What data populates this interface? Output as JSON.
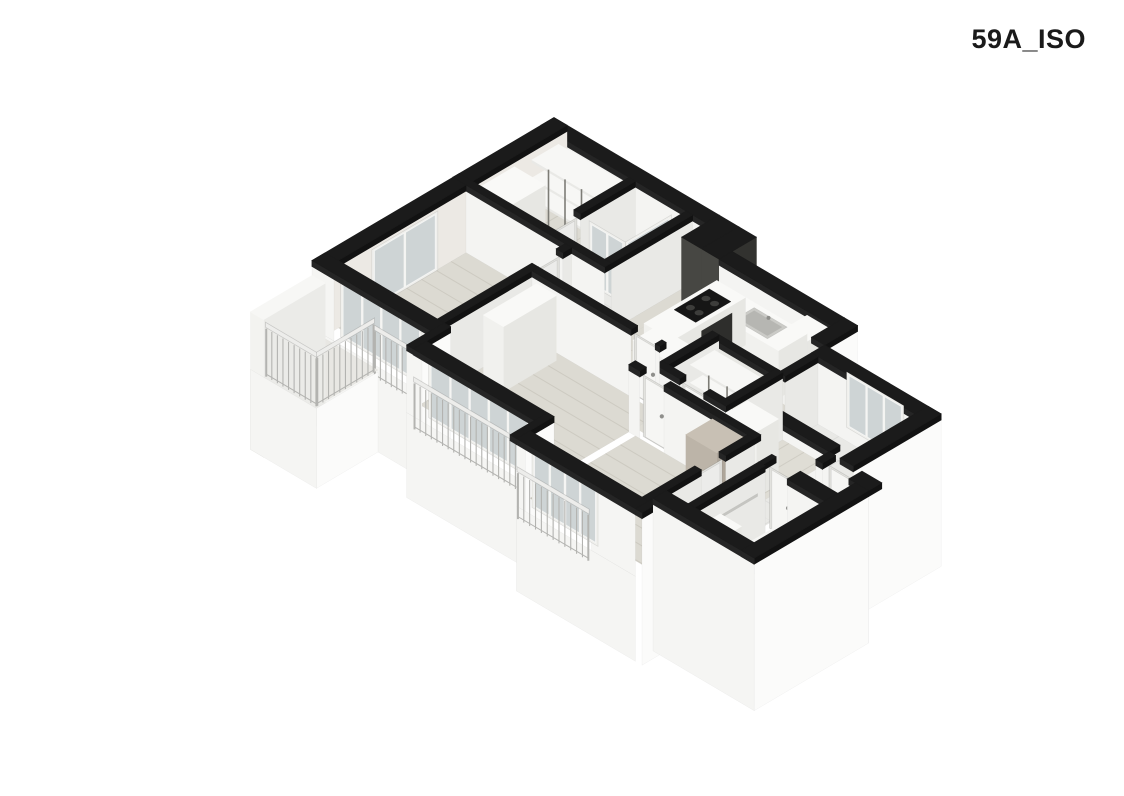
{
  "title": "59A_ISO",
  "canvas": {
    "width": 1124,
    "height": 796,
    "background": "#ffffff"
  },
  "projection": {
    "cx": 554,
    "cy": 185,
    "ax": 44,
    "ay": 26,
    "vz": 50
  },
  "palette": {
    "ink": "#1a1a1a",
    "capTop": "#1b1b1b",
    "capSW": "#252525",
    "capSE": "#121212",
    "intSW": "#f4f4f2",
    "intSE": "#e9e9e6",
    "intNW": "#ece9e4",
    "intDim": "#e7e7e3",
    "skirtSW": "#f5f5f3",
    "skirtSE": "#fbfbfa",
    "wood": "#dcdad2",
    "wood2": "#dfddd5",
    "woodLine": "rgba(95,88,72,0.12)",
    "tile": "#e9e9e6",
    "tileLine": "rgba(0,0,0,0.05)",
    "balc": "#e8e7e3",
    "boxTop": "#f9f9f7",
    "boxSW": "#f1f1ee",
    "boxSE": "#e7e7e3",
    "frame": "#f0f0ed",
    "glass": "rgba(186,196,199,0.62)",
    "mull": "#f5f5f3",
    "railB": "#b3b3b0",
    "railTop": "#ededeb",
    "shelfTop": "#f7f7f5",
    "shelfFront": "#e9e9e6",
    "shelfEdge": "#e2e2de",
    "post": "#7d7c76",
    "doorFrame": "#e2e2de",
    "doorSW": "#f6f6f4",
    "doorSE": "#ececea",
    "handle": "#8f8f8c",
    "shaftSW": "#474743",
    "shaftSE": "#32322f",
    "dark": "#2e2e2c"
  },
  "scene": [
    {
      "t": "floor",
      "name": "closet-hall-floor",
      "u0": 0.3,
      "v0": 0.3,
      "u1": 2.0,
      "v1": 2.15,
      "fill": "$wood",
      "planks": "B"
    },
    {
      "t": "floor",
      "name": "shower-room-floor",
      "u0": 2.15,
      "v0": 0.3,
      "u1": 3.3,
      "v1": 2.15,
      "fill": "$tile",
      "tiles": 0.47
    },
    {
      "t": "floor",
      "name": "vestibule-floor",
      "u0": 3.45,
      "v0": 0.3,
      "u1": 3.75,
      "v1": 2.3,
      "fill": "$wood",
      "planks": "B"
    },
    {
      "t": "wall",
      "name": "exterior-wall-north",
      "u0": 0,
      "v0": 0,
      "u1": 3.75,
      "v1": 0.3,
      "sw": "$intSW"
    },
    {
      "t": "wall",
      "name": "exterior-wall-northwest-upper",
      "u0": 0,
      "v0": 0,
      "u1": 0.3,
      "v1": 2.3,
      "se": "$intNW"
    },
    {
      "t": "shelf",
      "name": "closet-shelving",
      "u0": 0.45,
      "v0": 0.35,
      "u1": 1.95,
      "v1": 0.95,
      "levels": [
        0.42,
        0.82,
        1.18
      ],
      "posts": 3
    },
    {
      "t": "box",
      "name": "hall-wardrobe",
      "u0": 0.45,
      "v0": 1.35,
      "u1": 1.15,
      "v1": 2.1,
      "z0": 0,
      "z1": 1.3
    },
    {
      "t": "wall",
      "name": "closet-shower-partition",
      "u0": 2.0,
      "v0": 0.3,
      "u1": 2.15,
      "v1": 1.55,
      "se": "$intSE"
    },
    {
      "t": "door",
      "name": "shower-room-door",
      "dir": "B",
      "line": 2.07,
      "s0": 1.55,
      "s1": 2.1,
      "face": "se"
    },
    {
      "t": "glass",
      "name": "shower-glass-side",
      "dir": "B",
      "line": 3.12,
      "s0": 0.45,
      "s1": 1.5,
      "z0": 0,
      "z1": 1.26,
      "mullions": 0
    },
    {
      "t": "glass",
      "name": "shower-glass-front",
      "dir": "A",
      "line": 1.5,
      "s0": 2.3,
      "s1": 3.12,
      "z0": 0,
      "z1": 1.26,
      "mullions": 1
    },
    {
      "t": "wall",
      "name": "shower-east-wall",
      "u0": 3.3,
      "v0": 0.3,
      "u1": 3.45,
      "v1": 2.15,
      "se": "$intSE"
    },
    {
      "t": "wall",
      "name": "hall-south-wall",
      "u0": 0,
      "v0": 2.15,
      "u1": 3.45,
      "v1": 2.3,
      "sw": "$intSW"
    },
    {
      "t": "shaft",
      "name": "duct-shaft-1",
      "u0": 3.75,
      "v0": 0,
      "u1": 4.2,
      "v1": 0.85
    },
    {
      "t": "shaft",
      "name": "duct-shaft-2",
      "u0": 4.2,
      "v0": 0,
      "u1": 4.6,
      "v1": 0.85
    },
    {
      "t": "floor",
      "name": "kitchen-floor",
      "u0": 3.75,
      "v0": 0.85,
      "u1": 7.15,
      "v1": 2.3,
      "fill": "$wood",
      "planks": "B"
    },
    {
      "t": "wall",
      "name": "kitchen-north-wall",
      "u0": 4.6,
      "v0": 0.55,
      "u1": 7.15,
      "v1": 0.85,
      "sw": "$intSW"
    },
    {
      "t": "box",
      "name": "kitchen-tall-cabinet",
      "u0": 6.65,
      "v0": 0.9,
      "u1": 7.15,
      "v1": 1.6,
      "z0": 0,
      "z1": 1.32
    },
    {
      "t": "box",
      "name": "kitchen-counter",
      "u0": 5.25,
      "v0": 0.9,
      "u1": 6.65,
      "v1": 1.55,
      "z0": 0,
      "z1": 0.95
    },
    {
      "t": "sink",
      "name": "kitchen-sink",
      "u0": 5.55,
      "v0": 1.0,
      "u1": 6.3,
      "v1": 1.45,
      "z": 0.95
    },
    {
      "t": "box",
      "name": "kitchen-counter-return",
      "u0": 4.6,
      "v0": 0.9,
      "u1": 5.25,
      "v1": 2.55,
      "z0": 0,
      "z1": 0.95
    },
    {
      "t": "cooktop",
      "name": "cooktop",
      "u0": 4.68,
      "v0": 1.15,
      "u1": 5.17,
      "v1": 1.95,
      "z": 0.95
    },
    {
      "t": "face",
      "name": "oven-front",
      "dir": "B",
      "line": 5.25,
      "s0": 1.2,
      "s1": 1.9,
      "z0": 0.18,
      "z1": 0.8,
      "fill": "$dark"
    },
    {
      "t": "wall",
      "name": "kitchen-laundry-step-wall",
      "u0": 7.15,
      "v0": 0.55,
      "u1": 7.45,
      "v1": 1.3,
      "se": "$skirtSE",
      "z0": -1.7
    },
    {
      "t": "wall",
      "name": "laundry-north-wall",
      "u0": 7.45,
      "v0": 1.3,
      "u1": 10.1,
      "v1": 1.6,
      "sw": "$intSW"
    },
    {
      "t": "glass",
      "name": "laundry-window",
      "dir": "A",
      "line": 1.45,
      "s0": 8.1,
      "s1": 9.4,
      "z0": 0.12,
      "z1": 1.23,
      "mullions": 2
    },
    {
      "t": "floor",
      "name": "laundry-floor",
      "u0": 7.6,
      "v0": 1.6,
      "u1": 9.8,
      "v1": 3.05,
      "fill": "$tile",
      "tiles": 0.47
    },
    {
      "t": "wall",
      "name": "laundry-west-wall-a",
      "u0": 7.45,
      "v0": 1.6,
      "u1": 7.6,
      "v1": 2.35,
      "se": "$intSE"
    },
    {
      "t": "door",
      "name": "laundry-door",
      "dir": "B",
      "line": 7.52,
      "s0": 2.35,
      "s1": 2.9,
      "face": "se"
    },
    {
      "t": "wall",
      "name": "laundry-west-wall-b",
      "u0": 7.45,
      "v0": 2.9,
      "u1": 7.6,
      "v1": 3.05,
      "se": "$intSE"
    },
    {
      "t": "wall",
      "name": "laundry-south-wall",
      "u0": 7.6,
      "v0": 3.05,
      "u1": 9.55,
      "v1": 3.3,
      "sw": "$intSW"
    },
    {
      "t": "wall",
      "name": "laundry-east-wall",
      "u0": 9.8,
      "v0": 1.3,
      "u1": 10.1,
      "v1": 3.3,
      "se": "$skirtSE",
      "z0": -1.7
    },
    {
      "t": "floor",
      "name": "living-floor-west",
      "u0": 2.7,
      "v0": 2.3,
      "u1": 5.6,
      "v1": 3.05,
      "fill": "$wood2",
      "planks": "B"
    },
    {
      "t": "floor",
      "name": "living-floor-east",
      "u0": 5.6,
      "v0": 2.3,
      "u1": 8.45,
      "v1": 3.75,
      "fill": "$wood2",
      "planks": "B"
    },
    {
      "t": "box",
      "name": "kitchen-island",
      "u0": 4.8,
      "v0": 2.45,
      "u1": 5.85,
      "v1": 3.0,
      "z0": 0,
      "z1": 0.95
    },
    {
      "t": "wall",
      "name": "storage-north-wall",
      "u0": 6.05,
      "v0": 2.3,
      "u1": 7.5,
      "v1": 2.45,
      "sw": "$intDim"
    },
    {
      "t": "wall",
      "name": "storage-west-wall",
      "u0": 5.9,
      "v0": 2.3,
      "u1": 6.05,
      "v1": 3.45,
      "se": "$intSE"
    },
    {
      "t": "floor",
      "name": "storage-floor",
      "u0": 6.05,
      "v0": 2.45,
      "u1": 7.5,
      "v1": 3.45,
      "fill": "$wood",
      "planks": "B"
    },
    {
      "t": "shelf",
      "name": "storage-shelving",
      "u0": 6.15,
      "v0": 2.5,
      "u1": 7.4,
      "v1": 3.05,
      "levels": [
        0.4,
        0.78,
        1.14
      ],
      "posts": 2
    },
    {
      "t": "box",
      "name": "storage-cabinet-1",
      "u0": 6.15,
      "v0": 2.55,
      "u1": 6.7,
      "v1": 3.0,
      "z0": 0,
      "z1": 0.36
    },
    {
      "t": "box",
      "name": "storage-cabinet-2",
      "u0": 6.8,
      "v0": 2.55,
      "u1": 7.35,
      "v1": 3.0,
      "z0": 0,
      "z1": 0.36
    },
    {
      "t": "wall",
      "name": "storage-east-wall",
      "u0": 7.35,
      "v0": 2.3,
      "u1": 7.5,
      "v1": 3.45,
      "se": "$intSE"
    },
    {
      "t": "wall",
      "name": "storage-south-wall-a",
      "u0": 5.9,
      "v0": 3.45,
      "u1": 6.45,
      "v1": 3.6,
      "sw": "$intSW"
    },
    {
      "t": "door",
      "name": "storage-door",
      "dir": "A",
      "line": 3.52,
      "s0": 6.45,
      "s1": 7.0,
      "face": "sw"
    },
    {
      "t": "wall",
      "name": "storage-south-wall-b",
      "u0": 7.0,
      "v0": 3.45,
      "u1": 7.5,
      "v1": 3.6,
      "sw": "$intSW"
    },
    {
      "t": "box",
      "name": "hall-cabinet",
      "u0": 7.6,
      "v0": 3.2,
      "u1": 8.3,
      "v1": 3.7,
      "z0": 0,
      "z1": 1.3
    },
    {
      "t": "floor",
      "name": "entry-hall-floor",
      "u0": 8.45,
      "v0": 3.2,
      "u1": 10.35,
      "v1": 4.0,
      "fill": "$tile",
      "tiles": 0.47
    },
    {
      "t": "wall",
      "name": "entry-wall-west-stub",
      "u0": 9.55,
      "v0": 3.3,
      "u1": 9.7,
      "v1": 3.6,
      "sw": "$skirtSW",
      "z0": -1.7
    },
    {
      "t": "face",
      "name": "entrance-door-sill",
      "dir": "A",
      "line": 3.6,
      "s0": 9.7,
      "s1": 10.3,
      "z0": -1.7,
      "z1": 0.02,
      "fill": "$skirtSW"
    },
    {
      "t": "door",
      "name": "entrance-door",
      "dir": "A",
      "line": 3.45,
      "s0": 9.7,
      "s1": 10.3,
      "face": "sw",
      "handle": true
    },
    {
      "t": "wall",
      "name": "entry-wall-east-stub",
      "u0": 10.3,
      "v0": 3.3,
      "u1": 10.75,
      "v1": 3.6,
      "sw": "$skirtSW",
      "z0": -1.7
    },
    {
      "t": "floor",
      "name": "bed1-floor",
      "u0": 0.3,
      "v0": 2.3,
      "u1": 2.55,
      "v1": 5.2,
      "fill": "$wood",
      "planks": "A"
    },
    {
      "t": "wall",
      "name": "exterior-wall-northwest-lower",
      "u0": 0,
      "v0": 2.3,
      "u1": 0.3,
      "v1": 5.5,
      "se": "$intNW"
    },
    {
      "t": "glass",
      "name": "bed1-side-window",
      "dir": "B",
      "line": 0.36,
      "s0": 3.0,
      "s1": 4.5,
      "z0": 0.05,
      "z1": 1.23,
      "mullions": 1
    },
    {
      "t": "wall",
      "name": "bed1-bed2-wall-a",
      "u0": 2.55,
      "v0": 2.3,
      "u1": 2.7,
      "v1": 2.5,
      "se": "$intSE"
    },
    {
      "t": "door",
      "name": "bed1-door",
      "dir": "B",
      "line": 2.62,
      "s0": 2.5,
      "s1": 3.05,
      "face": "se"
    },
    {
      "t": "wall",
      "name": "bed1-bed2-wall-b",
      "u0": 2.55,
      "v0": 3.05,
      "u1": 2.7,
      "v1": 5.2,
      "se": "$intSE"
    },
    {
      "t": "face",
      "name": "bed1-window-skirt",
      "dir": "A",
      "line": 5.5,
      "s0": 0,
      "s1": 2.85,
      "z0": -1.7,
      "z1": 0,
      "fill": "$skirtSW"
    },
    {
      "t": "face",
      "name": "bed1-window-pier-left",
      "dir": "A",
      "line": 5.5,
      "s0": 0,
      "s1": 0.5,
      "z0": 0,
      "z1": 1.23,
      "fill": "$skirtSW"
    },
    {
      "t": "face",
      "name": "bed1-window-pier-right",
      "dir": "A",
      "line": 5.5,
      "s0": 2.35,
      "s1": 2.85,
      "z0": 0,
      "z1": 1.23,
      "fill": "$skirtSW"
    },
    {
      "t": "glass",
      "name": "bed1-window",
      "dir": "A",
      "line": 5.35,
      "s0": 0.5,
      "s1": 2.35,
      "z0": 0,
      "z1": 1.23,
      "mullions": 3
    },
    {
      "t": "cap",
      "name": "bed1-window-wall-cap",
      "u0": 0,
      "v0": 5.2,
      "u1": 2.85,
      "v1": 5.5
    },
    {
      "t": "rail",
      "name": "bed1-railing",
      "dir": "A",
      "line": 5.62,
      "s0": 1.55,
      "s1": 2.42,
      "z0": -0.12,
      "z1": 0.92
    },
    {
      "t": "wall",
      "name": "bay-step-wall-1",
      "u0": 2.7,
      "v0": 5.2,
      "u1": 2.85,
      "v1": 6.05,
      "se": "$skirtSE",
      "z0": -1.7
    },
    {
      "t": "floor",
      "name": "balcony-floor",
      "u0": 0.02,
      "v0": 5.5,
      "u1": 1.5,
      "v1": 6.85,
      "fill": "$balc",
      "z": -0.06
    },
    {
      "t": "box",
      "name": "balcony-side-wall",
      "u0": 0,
      "v0": 5.5,
      "u1": 0.3,
      "v1": 6.9,
      "z0": -1.7,
      "z1": 1.05,
      "top": "#f7f7f5",
      "swF": "#f3f3f0",
      "seF": "#ebebe8"
    },
    {
      "t": "face",
      "name": "balcony-skirt-front",
      "dir": "A",
      "line": 6.9,
      "s0": 0,
      "s1": 1.5,
      "z0": -1.7,
      "z1": -0.1,
      "fill": "$skirtSW"
    },
    {
      "t": "face",
      "name": "balcony-skirt-side",
      "dir": "B",
      "line": 1.5,
      "s0": 5.5,
      "s1": 6.9,
      "z0": -1.7,
      "z1": -0.1,
      "fill": "$skirtSE"
    },
    {
      "t": "rail",
      "name": "balcony-railing-front",
      "dir": "A",
      "line": 6.86,
      "s0": 0.32,
      "s1": 1.46,
      "z0": -0.1,
      "z1": 0.98
    },
    {
      "t": "rail",
      "name": "balcony-railing-side",
      "dir": "B",
      "line": 1.46,
      "s0": 5.56,
      "s1": 6.84,
      "z0": -0.1,
      "z1": 0.98
    },
    {
      "t": "wall",
      "name": "bed2-north-wall-a",
      "u0": 2.7,
      "v0": 3.05,
      "u1": 4.95,
      "v1": 3.2,
      "sw": "$intSW"
    },
    {
      "t": "door",
      "name": "bed2-door",
      "dir": "A",
      "line": 3.12,
      "s0": 4.95,
      "s1": 5.5,
      "face": "sw"
    },
    {
      "t": "wall",
      "name": "bed2-north-wall-b",
      "u0": 5.5,
      "v0": 3.05,
      "u1": 5.6,
      "v1": 3.2,
      "sw": "$intSW"
    },
    {
      "t": "floor",
      "name": "bed2-floor",
      "u0": 2.7,
      "v0": 3.2,
      "u1": 5.6,
      "v1": 5.75,
      "fill": "$wood",
      "planks": "A"
    },
    {
      "t": "box",
      "name": "bed2-wardrobe",
      "u0": 2.95,
      "v0": 3.35,
      "u1": 3.4,
      "v1": 4.55,
      "z0": 0,
      "z1": 1.3
    },
    {
      "t": "face",
      "name": "bed2-window-skirt",
      "dir": "A",
      "line": 6.05,
      "s0": 2.7,
      "s1": 5.75,
      "z0": -1.7,
      "z1": 0,
      "fill": "$skirtSW"
    },
    {
      "t": "face",
      "name": "bed2-window-pier-left",
      "dir": "A",
      "line": 6.05,
      "s0": 2.7,
      "s1": 3.05,
      "z0": 0,
      "z1": 1.23,
      "fill": "$skirtSW"
    },
    {
      "t": "face",
      "name": "bed2-window-pier-right",
      "dir": "A",
      "line": 6.05,
      "s0": 5.35,
      "s1": 5.75,
      "z0": 0,
      "z1": 1.23,
      "fill": "$skirtSW"
    },
    {
      "t": "glass",
      "name": "bed2-window",
      "dir": "A",
      "line": 5.9,
      "s0": 3.05,
      "s1": 5.35,
      "z0": 0,
      "z1": 1.23,
      "mullions": 4
    },
    {
      "t": "cap",
      "name": "bed2-window-wall-cap",
      "u0": 2.85,
      "v0": 5.75,
      "u1": 5.75,
      "v1": 6.05
    },
    {
      "t": "rail",
      "name": "bed2-railing",
      "dir": "A",
      "line": 6.17,
      "s0": 3.0,
      "s1": 5.42,
      "z0": -0.12,
      "z1": 0.92
    },
    {
      "t": "wall",
      "name": "bay-step-wall-2",
      "u0": 5.6,
      "v0": 5.75,
      "u1": 5.75,
      "v1": 6.6,
      "se": "$skirtSE",
      "z0": -1.7
    },
    {
      "t": "wall",
      "name": "bed3-north-wall-a",
      "u0": 5.6,
      "v0": 3.75,
      "u1": 5.85,
      "v1": 3.9,
      "sw": "$intSW"
    },
    {
      "t": "door",
      "name": "bed3-door",
      "dir": "A",
      "line": 3.82,
      "s0": 5.85,
      "s1": 6.4,
      "face": "sw"
    },
    {
      "t": "wall",
      "name": "bed3-north-wall-b",
      "u0": 6.4,
      "v0": 3.75,
      "u1": 8.45,
      "v1": 3.9,
      "sw": "$intSW"
    },
    {
      "t": "floor",
      "name": "bed3-floor",
      "u0": 5.75,
      "v0": 3.9,
      "u1": 8.3,
      "v1": 6.3,
      "fill": "$wood",
      "planks": "A"
    },
    {
      "t": "box",
      "name": "bed3-wardrobe",
      "u0": 7.55,
      "v0": 3.95,
      "u1": 8.25,
      "v1": 4.55,
      "z0": 0,
      "z1": 1.3,
      "top": "#c8c0b4",
      "swF": "#bcb4a8",
      "seF": "#aea69a"
    },
    {
      "t": "wall",
      "name": "bed3-east-wall-a",
      "u0": 8.3,
      "v0": 3.9,
      "u1": 8.45,
      "v1": 4.55,
      "se": "$intSE"
    },
    {
      "t": "door",
      "name": "bath-corridor-door",
      "dir": "B",
      "line": 8.37,
      "s0": 4.55,
      "s1": 5.1,
      "face": "se"
    },
    {
      "t": "wall",
      "name": "bed3-east-wall-b",
      "u0": 8.3,
      "v0": 5.1,
      "u1": 8.45,
      "v1": 6.3,
      "se": "$intSE"
    },
    {
      "t": "floor",
      "name": "bath-corridor-floor",
      "u0": 8.45,
      "v0": 4.0,
      "u1": 8.95,
      "v1": 5.9,
      "fill": "$tile",
      "tiles": 0.47
    },
    {
      "t": "wall",
      "name": "bathroom-north-wall-a",
      "u0": 8.95,
      "v0": 4.0,
      "u1": 9.05,
      "v1": 4.3,
      "sw": "$intSW"
    },
    {
      "t": "door",
      "name": "bathroom-door",
      "dir": "A",
      "line": 4.15,
      "s0": 9.05,
      "s1": 9.6,
      "face": "sw"
    },
    {
      "t": "wall",
      "name": "bathroom-north-wall-b",
      "u0": 9.6,
      "v0": 4.0,
      "u1": 10.45,
      "v1": 4.3,
      "sw": "$intSW"
    },
    {
      "t": "wall",
      "name": "bathroom-west-wall",
      "u0": 8.95,
      "v0": 4.3,
      "u1": 9.1,
      "v1": 5.9,
      "se": "$intSE"
    },
    {
      "t": "face",
      "name": "towel-bar",
      "dir": "B",
      "line": 9.13,
      "s0": 4.5,
      "s1": 5.35,
      "z0": 0.86,
      "z1": 0.92,
      "fill": "#c5c5c1"
    },
    {
      "t": "floor",
      "name": "bathroom-floor",
      "u0": 9.1,
      "v0": 4.3,
      "u1": 10.45,
      "v1": 5.9,
      "fill": "$tile",
      "tiles": 0.36
    },
    {
      "t": "tub",
      "name": "bathtub",
      "u0": 9.62,
      "v0": 4.4,
      "u1": 10.38,
      "v1": 5.82
    },
    {
      "t": "box",
      "name": "bathroom-cabinet",
      "u0": 9.1,
      "v0": 5.32,
      "u1": 9.58,
      "v1": 5.86,
      "z0": 0,
      "z1": 0.92
    },
    {
      "t": "face",
      "name": "bed3-window-skirt",
      "dir": "A",
      "line": 6.6,
      "s0": 5.75,
      "s1": 8.45,
      "z0": -1.7,
      "z1": 0,
      "fill": "$skirtSW"
    },
    {
      "t": "face",
      "name": "bed3-window-pier-left",
      "dir": "A",
      "line": 6.6,
      "s0": 5.75,
      "s1": 5.95,
      "z0": 0,
      "z1": 1.23,
      "fill": "$skirtSW"
    },
    {
      "t": "face",
      "name": "bed3-window-pier-right",
      "dir": "A",
      "line": 6.6,
      "s0": 7.45,
      "s1": 8.45,
      "z0": 0,
      "z1": 1.23,
      "fill": "$skirtSW"
    },
    {
      "t": "glass",
      "name": "bed3-window",
      "dir": "A",
      "line": 6.45,
      "s0": 5.95,
      "s1": 7.45,
      "z0": 0,
      "z1": 1.23,
      "mullions": 3
    },
    {
      "t": "cap",
      "name": "bed3-window-wall-cap",
      "u0": 5.75,
      "v0": 6.3,
      "u1": 8.45,
      "v1": 6.6
    },
    {
      "t": "rail",
      "name": "bed3-railing",
      "dir": "A",
      "line": 6.72,
      "s0": 5.9,
      "s1": 7.5,
      "z0": -0.12,
      "z1": 0.92
    },
    {
      "t": "wall",
      "name": "bay-step-wall-3",
      "u0": 8.45,
      "v0": 6.2,
      "u1": 8.6,
      "v1": 6.6,
      "se": "$skirtSE",
      "z0": -1.7
    },
    {
      "t": "wall",
      "name": "bathroom-south-wall",
      "u0": 8.45,
      "v0": 5.9,
      "u1": 10.75,
      "v1": 6.2,
      "sw": "$skirtSW",
      "z0": -1.7
    },
    {
      "t": "wall",
      "name": "bathroom-east-wall",
      "u0": 10.45,
      "v0": 3.6,
      "u1": 10.75,
      "v1": 6.2,
      "se": "$skirtSE",
      "z0": -1.7
    }
  ]
}
